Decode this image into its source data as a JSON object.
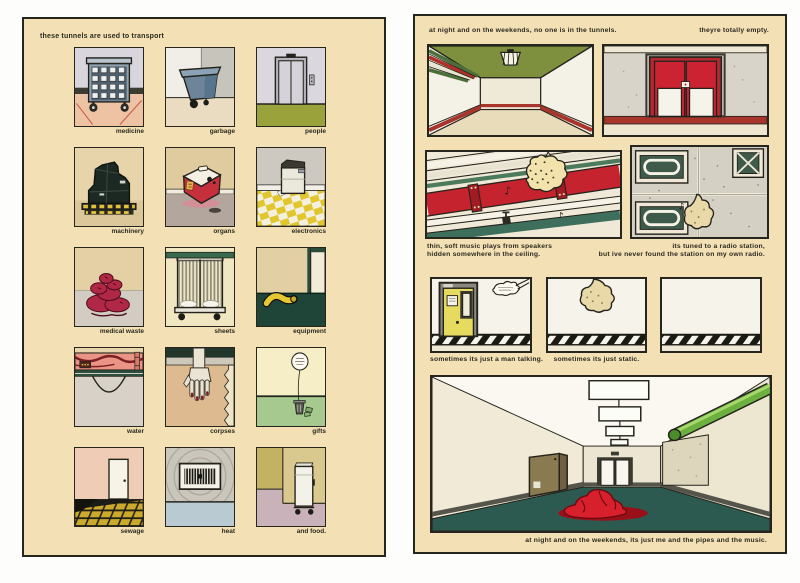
{
  "colors": {
    "paper": "#f3e0b4",
    "ink": "#26261e",
    "pipe_red": "#c5232d",
    "floor_teal": "#2c5a50",
    "ceiling_green": "#7e8f3e",
    "sound_blob": "#ead9a8"
  },
  "page_left": {
    "title": "these tunnels are used to transport",
    "items": [
      {
        "label": "medicine"
      },
      {
        "label": "garbage"
      },
      {
        "label": "people"
      },
      {
        "label": "machinery"
      },
      {
        "label": "organs"
      },
      {
        "label": "electronics"
      },
      {
        "label": "medical waste"
      },
      {
        "label": "sheets"
      },
      {
        "label": "equipment"
      },
      {
        "label": "water"
      },
      {
        "label": "corpses"
      },
      {
        "label": "gifts"
      },
      {
        "label": "sewage"
      },
      {
        "label": "heat"
      },
      {
        "label": "and food."
      }
    ]
  },
  "page_right": {
    "caption_top_left": "at night and on the weekends, no one is in the tunnels.",
    "caption_top_right": "theyre totally empty.",
    "caption_music": "thin, soft music plays from speakers\nhidden somewhere in the ceiling.",
    "caption_radio": "its tuned to a radio station,\nbut ive never found the station on my own radio.",
    "caption_talking": "sometimes its just a man talking.",
    "caption_static": "sometimes its just static.",
    "caption_bottom": "at night and on the weekends, its just me and the pipes and the music."
  }
}
